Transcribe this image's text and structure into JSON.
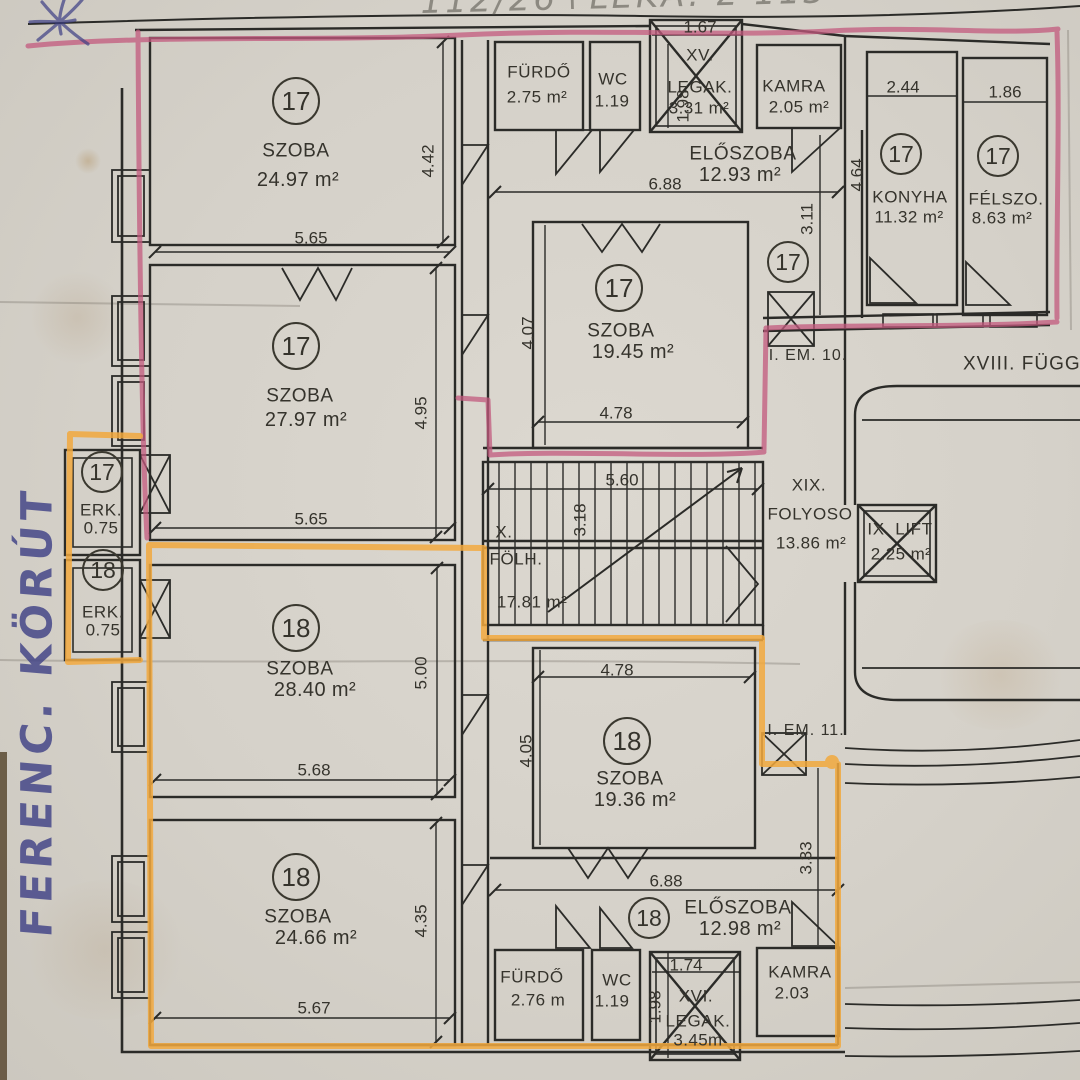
{
  "colors": {
    "paper": "#d5d1c9",
    "line": "#2b2b28",
    "highlight_pink": "#c35a7e",
    "highlight_orange": "#f2a93e",
    "ink_blue": "#3d3f85",
    "pencil": "#75726a"
  },
  "handwriting": {
    "top": "112/26+LEKA. Σ 113",
    "left": "FERENC. KÖRÚT"
  },
  "notes": {
    "em10": "I. EM. 10.",
    "em11": "I. EM. 11.",
    "gallery": "XVIII. FÜGGŐ"
  },
  "units": {
    "u17": "17",
    "u18": "18"
  },
  "rooms": {
    "szoba1": {
      "name": "SZOBA",
      "area": "24.97 m²"
    },
    "szoba2": {
      "name": "SZOBA",
      "area": "27.97 m²"
    },
    "szoba3": {
      "name": "SZOBA",
      "area": "19.45 m²"
    },
    "konyha": {
      "name": "KONYHA",
      "area": "11.32 m²"
    },
    "felszo": {
      "name": "FÉLSZO.",
      "area": "8.63 m²"
    },
    "furdo1": {
      "name": "FÜRDŐ",
      "area": "2.75 m²"
    },
    "wc1": {
      "name": "WC",
      "area": "1.19"
    },
    "legak1": {
      "prefix": "XV.",
      "name": "LEGAK.",
      "area": "3.31 m²"
    },
    "kamra1": {
      "name": "KAMRA",
      "area": "2.05 m²"
    },
    "eloszoba1": {
      "name": "ELŐSZOBA",
      "area": "12.93 m²"
    },
    "erk1": {
      "name": "ERK.",
      "area": "0.75"
    },
    "erk2": {
      "name": "ERK.",
      "area": "0.75"
    },
    "folh": {
      "prefix": "X.",
      "name": "FÖLH.",
      "area": "17.81 m²"
    },
    "folyoso": {
      "prefix": "XIX.",
      "name": "FOLYOSO",
      "area": "13.86 m²"
    },
    "lift": {
      "name": "IX. LIFT",
      "area": "2.25 m²"
    },
    "szoba4": {
      "name": "SZOBA",
      "area": "28.40 m²"
    },
    "szoba5": {
      "name": "SZOBA",
      "area": "24.66 m²"
    },
    "szoba6": {
      "name": "SZOBA",
      "area": "19.36 m²"
    },
    "eloszoba2": {
      "name": "ELŐSZOBA",
      "area": "12.98 m²"
    },
    "furdo2": {
      "name": "FÜRDŐ",
      "area": "2.76 m"
    },
    "wc2": {
      "name": "WC",
      "area": "1.19"
    },
    "legak2": {
      "prefix": "XVI.",
      "name": "LEGAK.",
      "area": "3.45m"
    },
    "kamra2": {
      "name": "KAMRA",
      "area": "2.03"
    }
  },
  "dims": {
    "d1": "5.65",
    "d2": "4.42",
    "d3": "5.65",
    "d4": "4.95",
    "d5": "1.67",
    "d6": "1.98",
    "d7": "6.88",
    "d8": "4.64",
    "d9": "3.11",
    "d10": "2.44",
    "d11": "1.86",
    "d12": "4.07",
    "d13": "4.78",
    "d14": "5.60",
    "d15": "3.18",
    "d16": "5.68",
    "d17": "5.00",
    "d18": "4.78",
    "d19": "4.05",
    "d20": "6.88",
    "d21": "3.33",
    "d22": "5.67",
    "d23": "4.35",
    "d24": "1.74",
    "d25": "1.98"
  }
}
